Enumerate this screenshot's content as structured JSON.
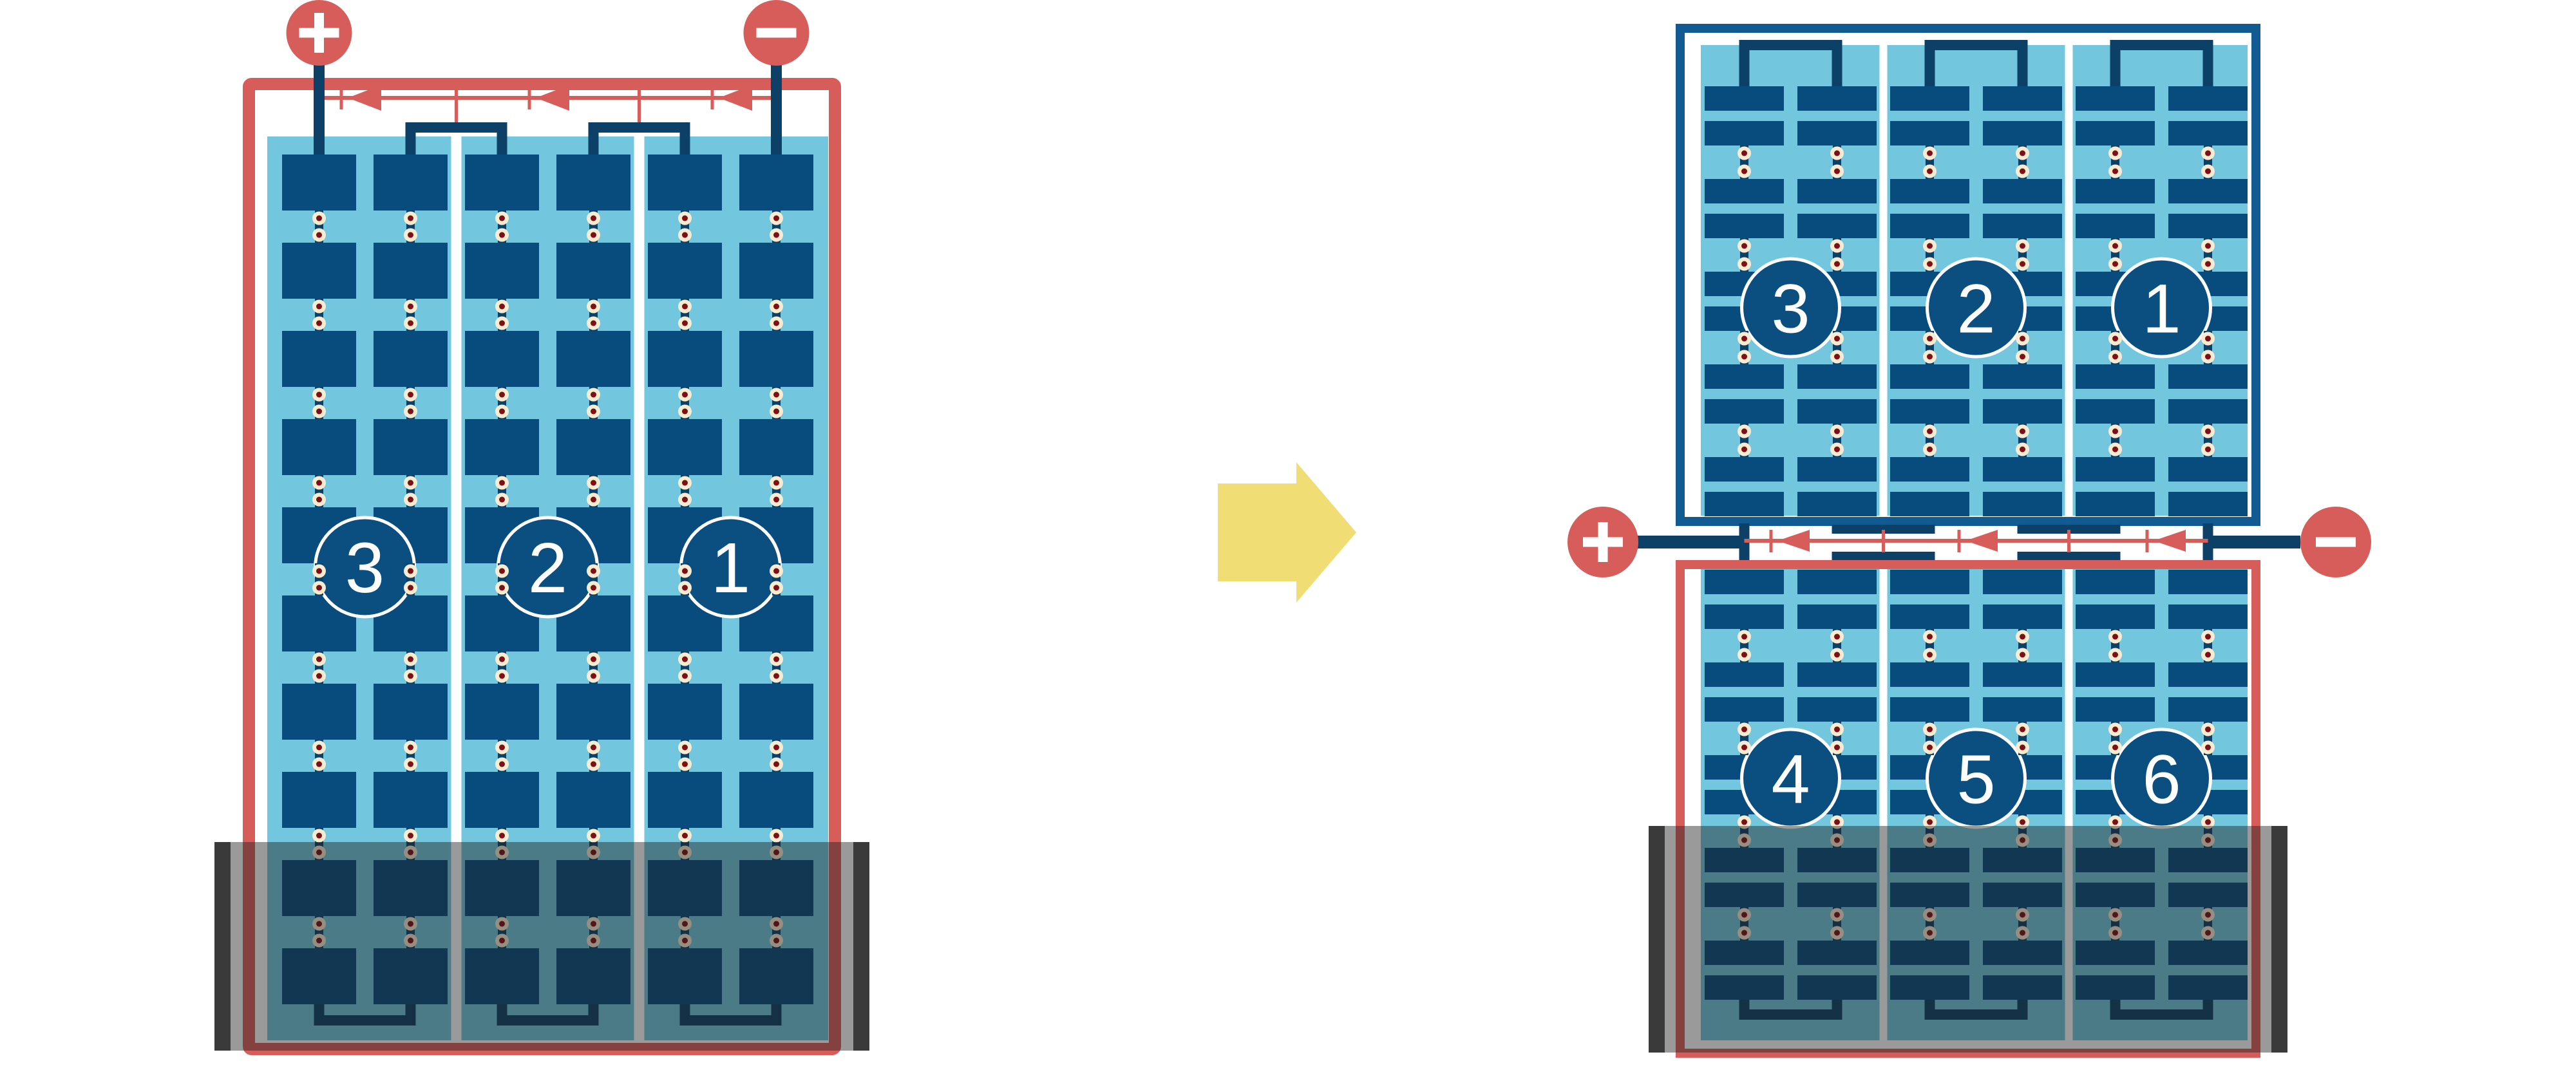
{
  "title": "Solar module bypass diode wiring: standard full-cell module vs half-cut cell module with shaded bottom rows",
  "colors": {
    "background": "#FFFFFF",
    "red": "#D75D5B",
    "frame_blue": "#125A92",
    "cell_blue": "#074C7D",
    "navy": "#0C4066",
    "light_blue": "#72C7DF",
    "white": "#FFFFFF",
    "solder_ring": "#F7ECD2",
    "solder_dot": "#7C1013",
    "shade_overlay": "rgba(30,30,30,0.45)",
    "shade_bar": "#3A3A3A",
    "arrow_yellow": "#F0DD74",
    "circle_fill": "#0A4F80",
    "label_text": "#FFFFFF"
  },
  "left_module": {
    "kind": "full-cell module",
    "terminals": {
      "positive": "+",
      "negative": "−"
    },
    "string_labels": [
      "3",
      "2",
      "1"
    ],
    "bypass_diode_count": 3
  },
  "right_module": {
    "kind": "half-cut cell module",
    "terminals": {
      "positive": "+",
      "negative": "−"
    },
    "top_string_labels": [
      "3",
      "2",
      "1"
    ],
    "bottom_string_labels": [
      "4",
      "5",
      "6"
    ],
    "bypass_diode_count": 3
  },
  "transform_arrow": {
    "direction": "right"
  }
}
